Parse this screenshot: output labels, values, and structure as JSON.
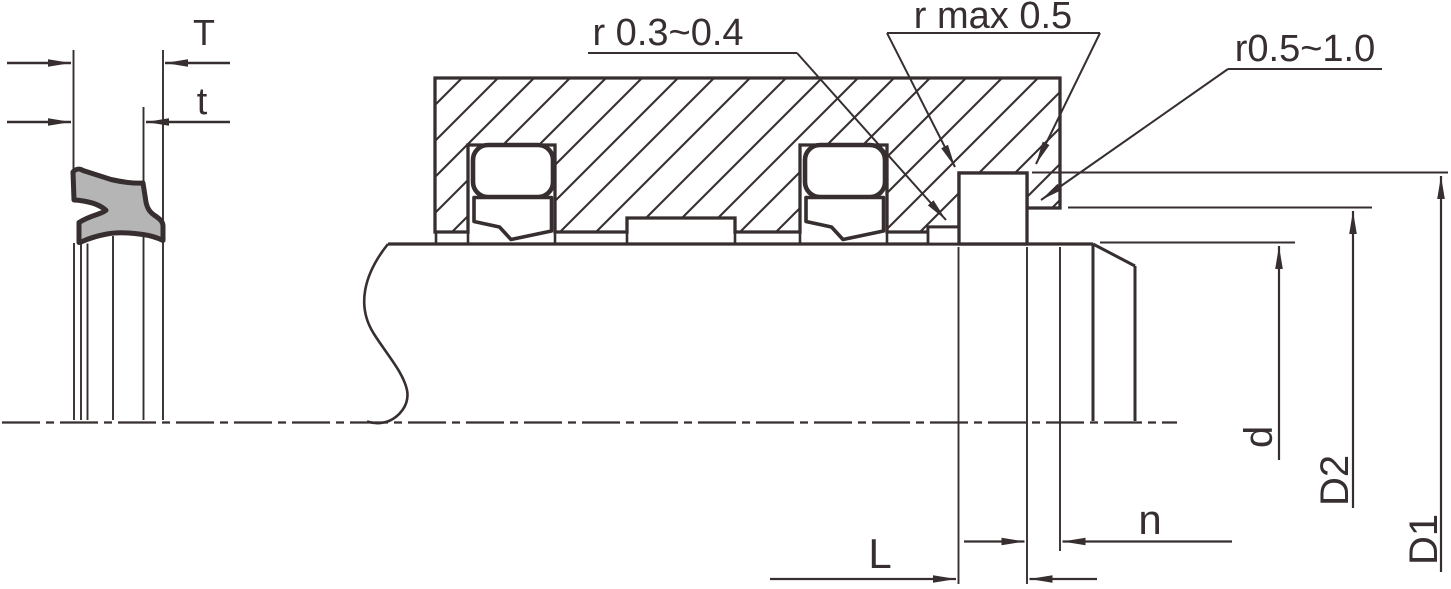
{
  "labels": {
    "T": "T",
    "t": "t",
    "r_groove": "r 0.3~0.4",
    "r_max": "r max 0.5",
    "r_shaft": "r0.5~1.0",
    "L": "L",
    "n": "n",
    "d": "d",
    "D2": "D2",
    "D1": "D1"
  },
  "colors": {
    "line": "#362e2f",
    "seal_fill": "#b5b5b5",
    "background": "#ffffff"
  }
}
